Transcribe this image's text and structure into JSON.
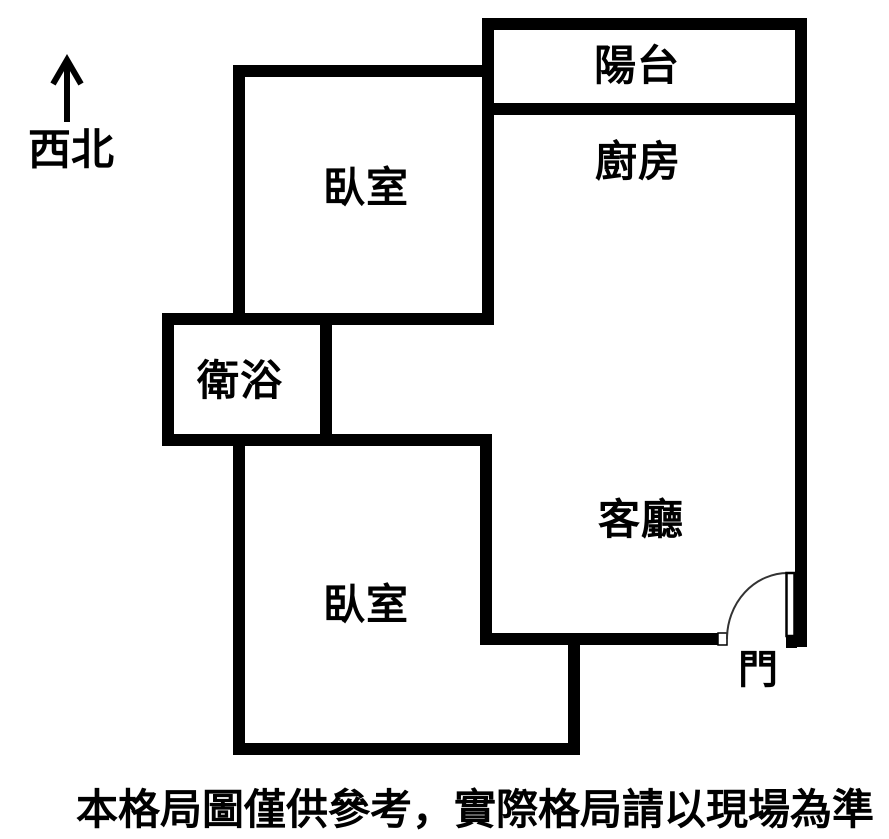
{
  "page": {
    "background_color": "#ffffff",
    "wall_color": "#000000",
    "text_color": "#000000"
  },
  "compass": {
    "icon": "north-arrow-icon",
    "label": "西北"
  },
  "rooms": {
    "balcony": {
      "label": "陽台"
    },
    "kitchen": {
      "label": "廚房"
    },
    "bedroom_top": {
      "label": "臥室"
    },
    "bathroom": {
      "label": "衛浴"
    },
    "living_room": {
      "label": "客廳"
    },
    "bedroom_bottom": {
      "label": "臥室"
    }
  },
  "door": {
    "label": "門"
  },
  "footer": {
    "disclaimer": "本格局圖僅供參考，實際格局請以現場為準"
  }
}
